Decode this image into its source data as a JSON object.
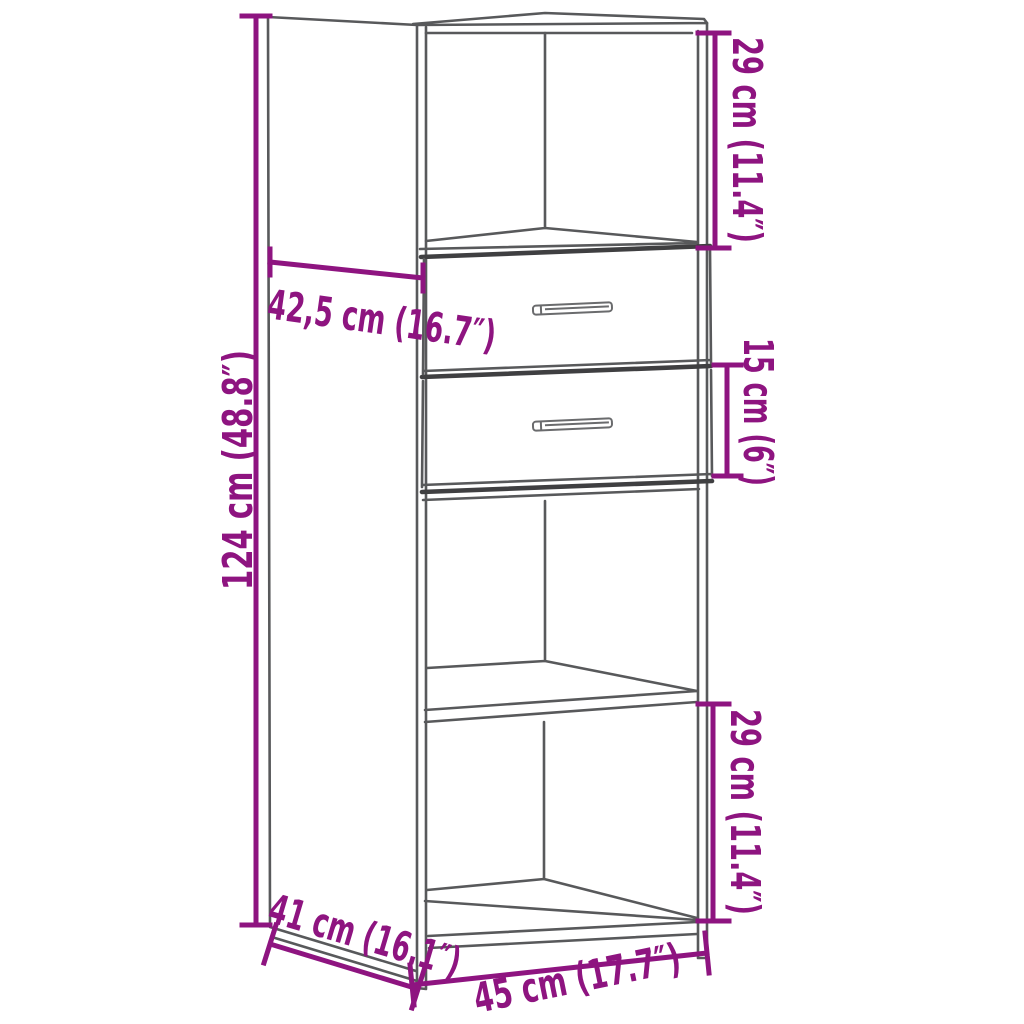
{
  "page": {
    "type": "product-dimension-diagram",
    "subject": "highboard cabinet line drawing",
    "background": "#FFFFFF"
  },
  "colors": {
    "dimension_accent": "#8E1480",
    "outline_gray": "#58595B",
    "outline_dark": "#3F3F41"
  },
  "dimensions": {
    "total_height": "124 cm (48.8″)",
    "upper_depth": "42,5 cm (16.7″)",
    "upper_compartment_height": "29 cm (11.4″)",
    "drawer_height": "15 cm (6″)",
    "lower_compartment_height": "29 cm (11.4″)",
    "lower_depth": "41 cm (16.1″)",
    "width": "45 cm (17.7″)"
  }
}
